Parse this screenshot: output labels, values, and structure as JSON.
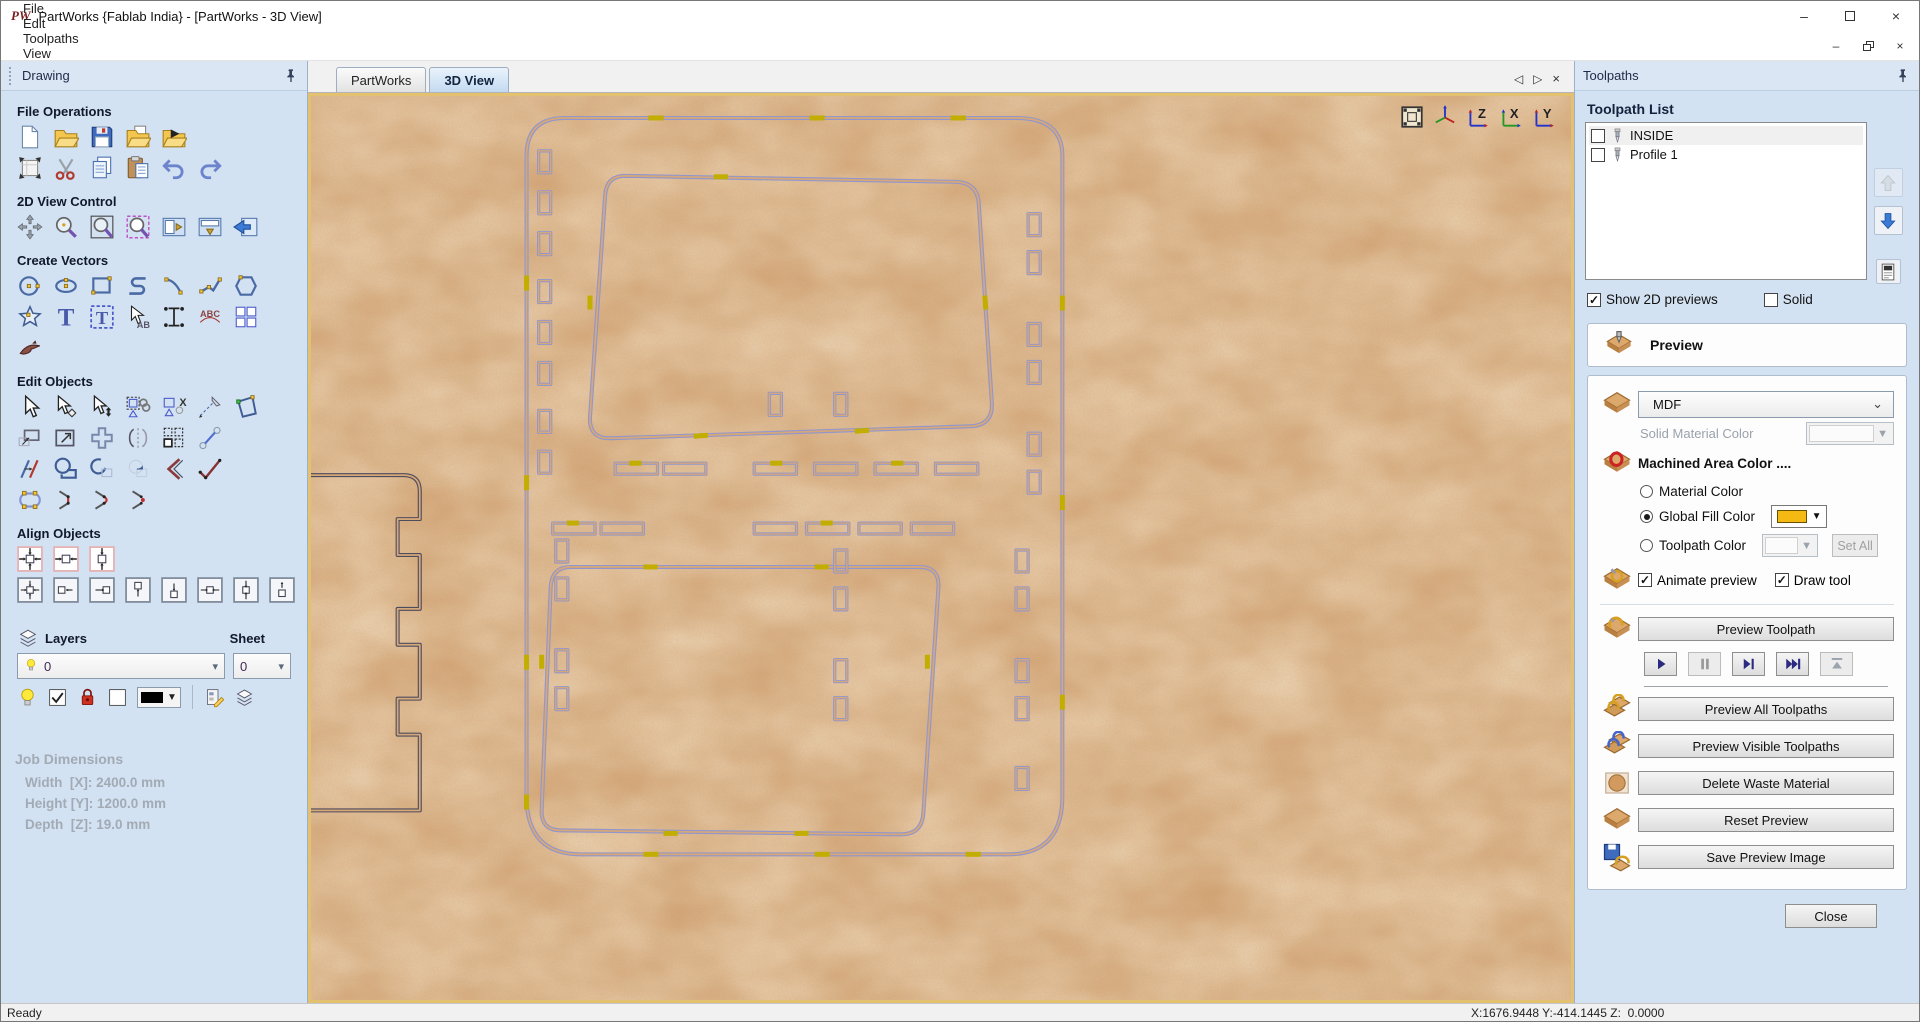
{
  "window": {
    "logo_text": "PW",
    "title": "PartWorks {Fablab India} - [PartWorks - 3D View]"
  },
  "menu": {
    "items": [
      "File",
      "Edit",
      "Toolpaths",
      "View",
      "Gadgets",
      "Help"
    ]
  },
  "tabs": [
    {
      "label": "PartWorks",
      "active": false
    },
    {
      "label": "3D View",
      "active": true
    }
  ],
  "drawing_panel": {
    "title": "Drawing",
    "sections": [
      {
        "title": "File Operations",
        "rows": [
          [
            "new-file",
            "open-file",
            "save-file",
            "import-file",
            "export-file"
          ],
          [
            "job-setup",
            "cut",
            "copy",
            "paste",
            "undo",
            "redo"
          ]
        ]
      },
      {
        "title": "2D View Control",
        "rows": [
          [
            "pan",
            "zoom",
            "zoom-box",
            "zoom-selected",
            "toggle-2d3d-a",
            "toggle-2d3d-b",
            "switch-window"
          ]
        ]
      },
      {
        "title": "Create Vectors",
        "rows": [
          [
            "circle",
            "ellipse",
            "rectangle",
            "polyline",
            "arc",
            "curve",
            "polygon"
          ],
          [
            "star",
            "text",
            "text-box",
            "select-text",
            "text-spacing",
            "text-on-curve",
            "paste-array"
          ],
          [
            "vector-texture"
          ]
        ]
      },
      {
        "title": "Edit Objects",
        "rows": [
          [
            "select",
            "node-edit",
            "transform",
            "group",
            "ungroup",
            "measure",
            "distort"
          ],
          [
            "offset",
            "set-size",
            "align-cross",
            "mirror",
            "array-copy",
            "fillet"
          ],
          [
            "trim",
            "weld",
            "subtract",
            "keep-overlap",
            "chamfer",
            "fit-curve"
          ],
          [
            "join-close",
            "join-move",
            "join-curve",
            "join-dot"
          ]
        ]
      },
      {
        "title": "Align Objects",
        "rows": [
          [
            "ac-both",
            "ac-h",
            "ac-v"
          ],
          [
            "af-center",
            "af-left",
            "af-right",
            "af-top",
            "af-bottom",
            "af-h",
            "af-v",
            "af-stack"
          ]
        ]
      }
    ],
    "layers": {
      "label": "Layers",
      "selected": "0",
      "sheet_label": "Sheet",
      "sheet_selected": "0"
    },
    "job_dimensions": {
      "title": "Job Dimensions",
      "lines": [
        "Width  [X]: 2400.0 mm",
        "Height [Y]: 1200.0 mm",
        "Depth  [Z]: 19.0 mm"
      ]
    }
  },
  "toolpaths_panel": {
    "title": "Toolpaths",
    "list_title": "Toolpath List",
    "items": [
      {
        "label": "INSIDE",
        "checked": false,
        "selected": true
      },
      {
        "label": "Profile 1",
        "checked": false,
        "selected": false
      }
    ],
    "show_2d": {
      "label": "Show 2D previews",
      "checked": true
    },
    "solid": {
      "label": "Solid",
      "checked": false
    },
    "preview": {
      "header": "Preview",
      "material": "MDF",
      "solid_material_color_label": "Solid Material Color",
      "machined_area_label": "Machined Area Color ....",
      "radios": [
        {
          "label": "Material Color",
          "selected": false
        },
        {
          "label": "Global Fill Color",
          "selected": true
        },
        {
          "label": "Toolpath Color",
          "selected": false
        }
      ],
      "global_fill_color": "#F5B913",
      "set_all": "Set All",
      "animate": {
        "label": "Animate preview",
        "checked": true
      },
      "draw_tool": {
        "label": "Draw tool",
        "checked": true
      },
      "preview_toolpath": "Preview Toolpath",
      "buttons": [
        {
          "icon": "wood-two",
          "label": "Preview All Toolpaths"
        },
        {
          "icon": "wood-two-blue",
          "label": "Preview Visible Toolpaths"
        },
        {
          "icon": "wood-waste",
          "label": "Delete Waste Material"
        },
        {
          "icon": "wood-plain",
          "label": "Reset Preview"
        },
        {
          "icon": "wood-save",
          "label": "Save Preview Image"
        }
      ],
      "close": "Close"
    }
  },
  "status": {
    "ready": "Ready",
    "coords": "X:1676.9448 Y:-414.1445 Z:  0.0000"
  },
  "colors": {
    "mdf": "#d6a777",
    "outline": "#8f96d0",
    "tab_marks": "#c2ae00",
    "canvas_border": "#e3c170",
    "global_fill": "#F5B913"
  }
}
